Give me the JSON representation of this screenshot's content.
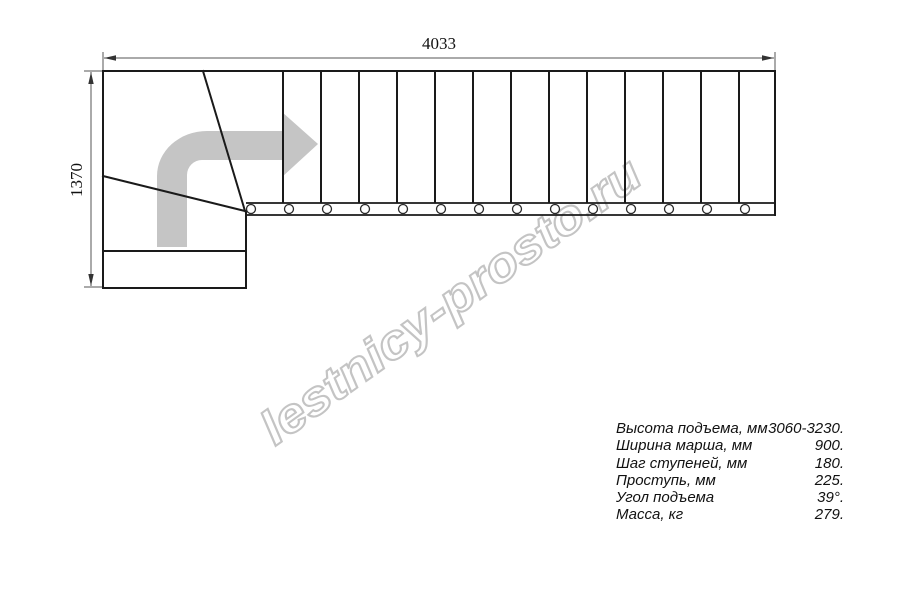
{
  "dimensions": {
    "width_label": "4033",
    "height_label": "1370"
  },
  "watermark": {
    "text": "lestnicy-prosto.ru"
  },
  "drawing": {
    "straight_step_lines": 13,
    "baluster_circles": 14
  },
  "specs": {
    "rows": [
      {
        "label": "Высота подъема, мм",
        "value": "3060-3230."
      },
      {
        "label": "Ширина марша, мм",
        "value": "900."
      },
      {
        "label": "Шаг ступеней, мм",
        "value": "180."
      },
      {
        "label": "Проступь, мм",
        "value": "225."
      },
      {
        "label": "Угол подъема",
        "value": "39°."
      },
      {
        "label": "Масса, кг",
        "value": "279."
      }
    ]
  },
  "colors": {
    "line": "#1a1a1a",
    "dimension_line": "#555555",
    "arrow_fill": "#c5c5c5",
    "watermark_outline": "#c4c4c4",
    "background": "#ffffff"
  }
}
